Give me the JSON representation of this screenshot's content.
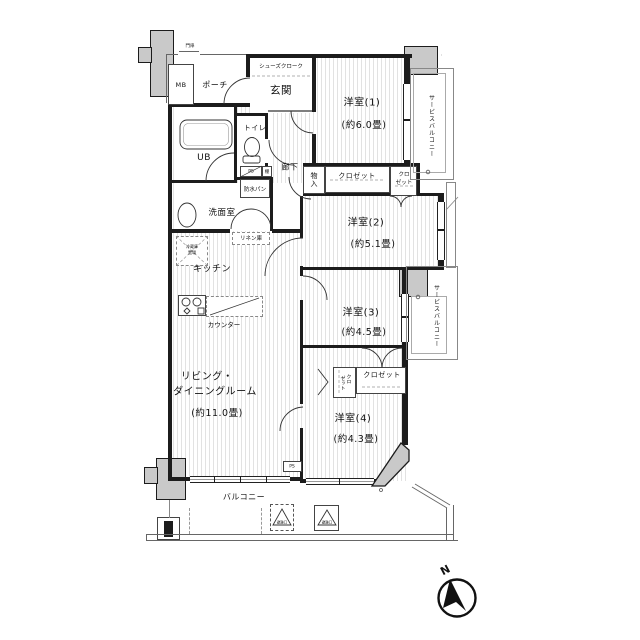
{
  "colors": {
    "wall": "#1c1c1c",
    "concrete": "#c9c9c9",
    "stripe": "#e2e2e2",
    "paper": "#ffffff"
  },
  "labels": {
    "mb": "MB",
    "gate": "門扉",
    "porch": "ポーチ",
    "genkan": "玄関",
    "shoes_cloak": "シューズクローク",
    "toilet": "トイレ",
    "ub": "UB",
    "ps": "PS",
    "shelf": "棚",
    "corridor": "廊下",
    "waterproof_pan": "防水パン",
    "washroom": "洗面室",
    "linen": "リネン庫",
    "fridge_l1": "冷蔵庫",
    "fridge_l2": "置場",
    "kitchen": "キッチン",
    "counter": "カウンター",
    "storage": "物入",
    "closet_w1": "クロゼット",
    "closet_small_l1": "クロ",
    "closet_small_l2": "ゼット",
    "closet_w4": "クロゼット",
    "closet_w4_side_c1": "クロ",
    "closet_w4_side_c2": "ゼット",
    "ps_lower": "PS",
    "balcony": "バルコニー",
    "service_balcony_1": "サービスバルコニー",
    "service_balcony_2": "サービスバルコニー",
    "hatch_1": "避難口",
    "hatch_2": "避難口",
    "north": "N"
  },
  "rooms": {
    "western1": {
      "name": "洋室(1)",
      "size": "(約6.0畳)"
    },
    "western2": {
      "name": "洋室(2)",
      "size": "(約5.1畳)"
    },
    "western3": {
      "name": "洋室(3)",
      "size": "(約4.5畳)"
    },
    "western4": {
      "name": "洋室(4)",
      "size": "(約4.3畳)"
    },
    "living": {
      "name_l1": "リビング・",
      "name_l2": "ダイニングルーム",
      "size": "(約11.0畳)"
    }
  }
}
